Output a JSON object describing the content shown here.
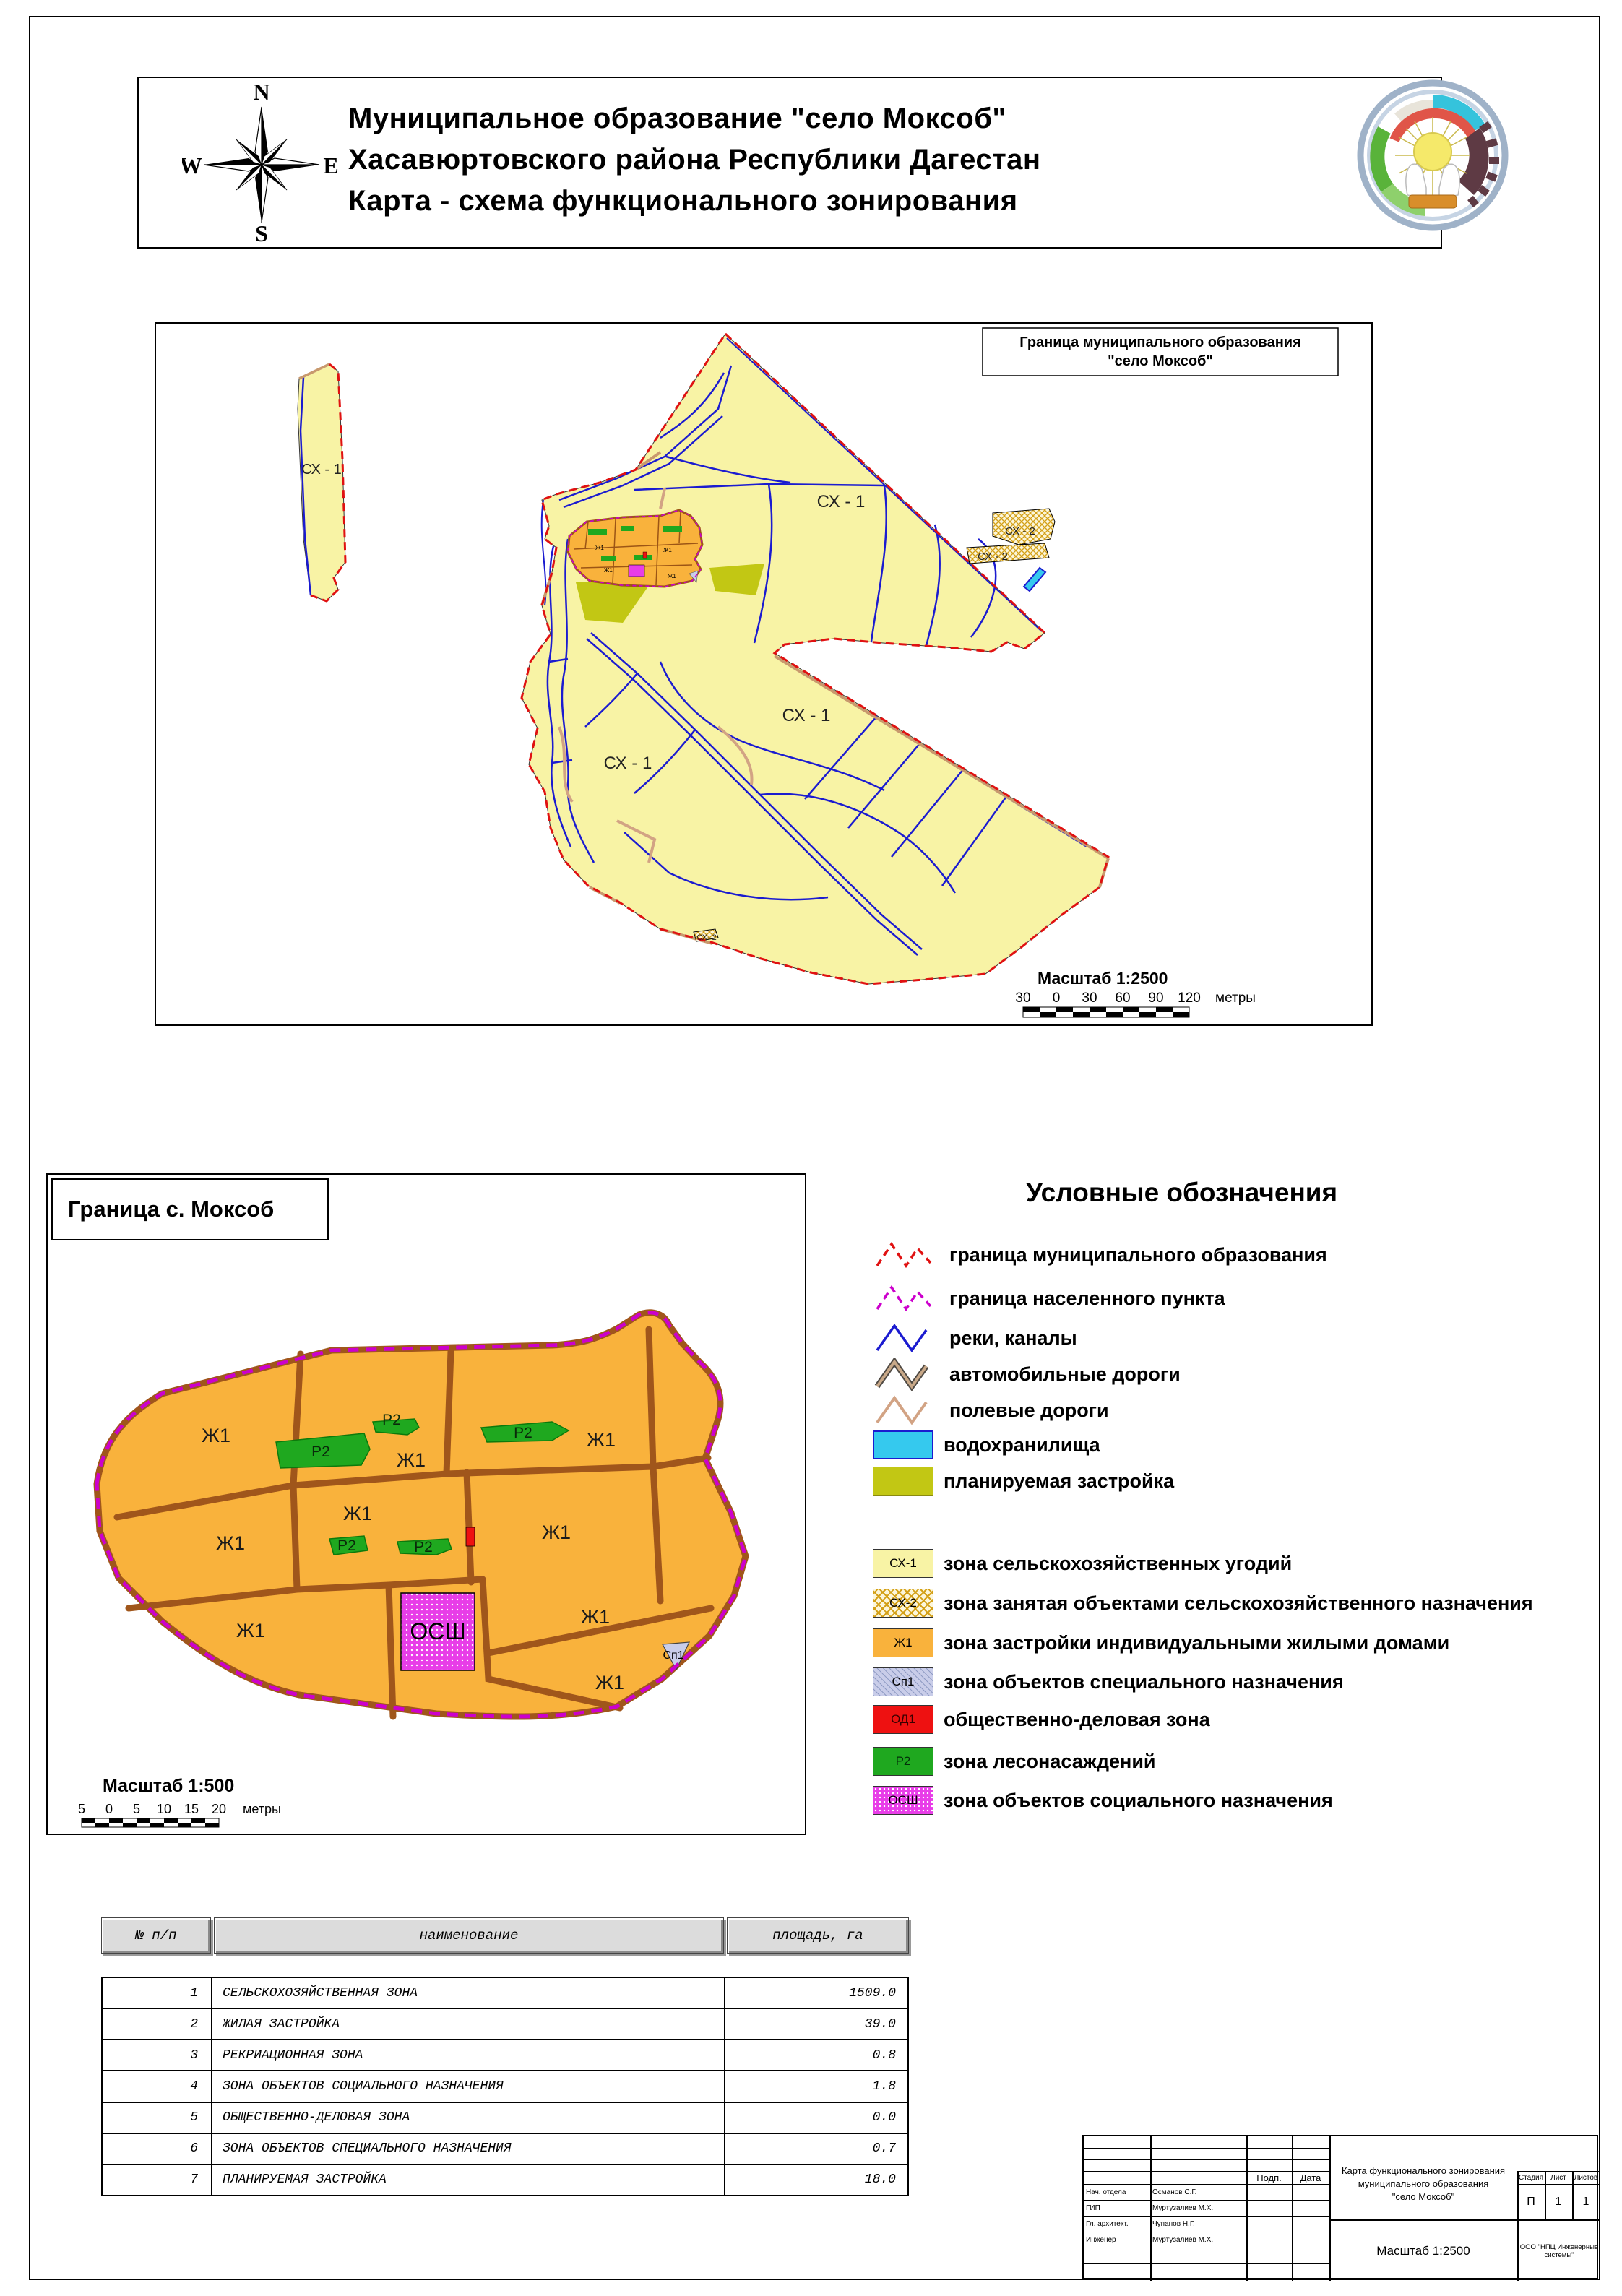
{
  "header": {
    "title_line1": "Муниципальное образование \"село Моксоб\"",
    "title_line2": "Хасавюртовского района Республики Дагестан",
    "title_line3": "Карта - схема функционального зонирования",
    "compass": {
      "n": "N",
      "s": "S",
      "w": "W",
      "e": "E"
    }
  },
  "main_map": {
    "boundary_box_line1": "Граница муниципального образования",
    "boundary_box_line2": "\"село Моксоб\"",
    "label_sx1": "СХ - 1",
    "label_sx2": "СХ - 2",
    "label_sx2_small": "СХ- 2",
    "label_zh": "Ж1",
    "scale_label": "Масштаб 1:2500",
    "scale_ticks": [
      "30",
      "0",
      "30",
      "60",
      "90",
      "120"
    ],
    "scale_unit": "метры"
  },
  "village_map": {
    "title": "Граница с. Моксоб",
    "label_zh": "Ж1",
    "label_p2": "Р2",
    "label_osh": "ОСШ",
    "label_sp1": "Сп1",
    "scale_label": "Масштаб 1:500",
    "scale_ticks": [
      "5",
      "0",
      "5",
      "10",
      "15",
      "20"
    ],
    "scale_unit": "метры"
  },
  "legend": {
    "title": "Условные обозначения",
    "line_items": [
      {
        "label": "граница муниципального образования"
      },
      {
        "label": "граница населенного пункта"
      },
      {
        "label": "реки, каналы"
      },
      {
        "label": "автомобильные дороги"
      },
      {
        "label": "полевые дороги"
      },
      {
        "label": "водохранилища"
      },
      {
        "label": "планируемая застройка"
      }
    ],
    "zone_items": [
      {
        "code": "СХ-1",
        "label": "зона сельскохозяйственных угодий"
      },
      {
        "code": "СХ-2",
        "label": "зона занятая объектами сельскохозяйственного назначения"
      },
      {
        "code": "Ж1",
        "label": "зона застройки индивидуальными жилыми домами"
      },
      {
        "code": "Сп1",
        "label": "зона объектов специального назначения"
      },
      {
        "code": "ОД1",
        "label": "общественно-деловая зона"
      },
      {
        "code": "Р2",
        "label": "зона лесонасаждений"
      },
      {
        "code": "ОСШ",
        "label": "зона объектов социального назначения"
      }
    ]
  },
  "table": {
    "headers": [
      "№ п/п",
      "наименование",
      "площадь, га"
    ],
    "rows": [
      {
        "num": "1",
        "name": "СЕЛЬСКОХОЗЯЙСТВЕННАЯ ЗОНА",
        "area": "1509.0"
      },
      {
        "num": "2",
        "name": "ЖИЛАЯ ЗАСТРОЙКА",
        "area": "39.0"
      },
      {
        "num": "3",
        "name": "РЕКРИАЦИОННАЯ ЗОНА",
        "area": "0.8"
      },
      {
        "num": "4",
        "name": "ЗОНА ОБЪЕКТОВ СОЦИАЛЬНОГО НАЗНАЧЕНИЯ",
        "area": "1.8"
      },
      {
        "num": "5",
        "name": "ОБЩЕСТВЕННО-ДЕЛОВАЯ ЗОНА",
        "area": "0.0"
      },
      {
        "num": "6",
        "name": "ЗОНА ОБЪЕКТОВ СПЕЦИАЛЬНОГО НАЗНАЧЕНИЯ",
        "area": "0.7"
      },
      {
        "num": "7",
        "name": "ПЛАНИРУЕМАЯ ЗАСТРОЙКА",
        "area": "18.0"
      }
    ]
  },
  "stamp": {
    "doc_title_line1": "Карта функционального зонирования",
    "doc_title_line2": "муниципального образования",
    "doc_title_line3": "\"село Моксоб\"",
    "col_podp": "Подп.",
    "col_data": "Дата",
    "roles": [
      [
        "Нач. отдела",
        "Османов С.Г."
      ],
      [
        "ГИП",
        "Муртузалиев М.Х."
      ],
      [
        "Гл. архитект.",
        "Чупанов Н.Г."
      ],
      [
        "Инженер",
        "Муртузалиев М.Х."
      ]
    ],
    "stage_label": "Стадия",
    "sheet_label": "Лист",
    "sheets_label": "Листов",
    "stage": "П",
    "sheet": "1",
    "sheets": "1",
    "scale": "Масштаб 1:2500",
    "company": "ООО \"НПЦ Инженерные системы\""
  },
  "colors": {
    "sx1_fill": "#f8f3a5",
    "sx2_hatch": "#d4a017",
    "zh_fill": "#f9b23c",
    "sp1_fill": "#c9cde9",
    "od1_fill": "#ee1111",
    "p2_fill": "#1fa81f",
    "osh_fill": "#e83de8",
    "water_fill": "#35c9ee",
    "planned_fill": "#c2c714",
    "municipal_boundary": "#e01111",
    "settlement_boundary": "#cc00cc",
    "river": "#1b1bd0",
    "road_auto": "#c8996e",
    "road_field": "#d2a384",
    "street_brown": "#a0561b"
  }
}
